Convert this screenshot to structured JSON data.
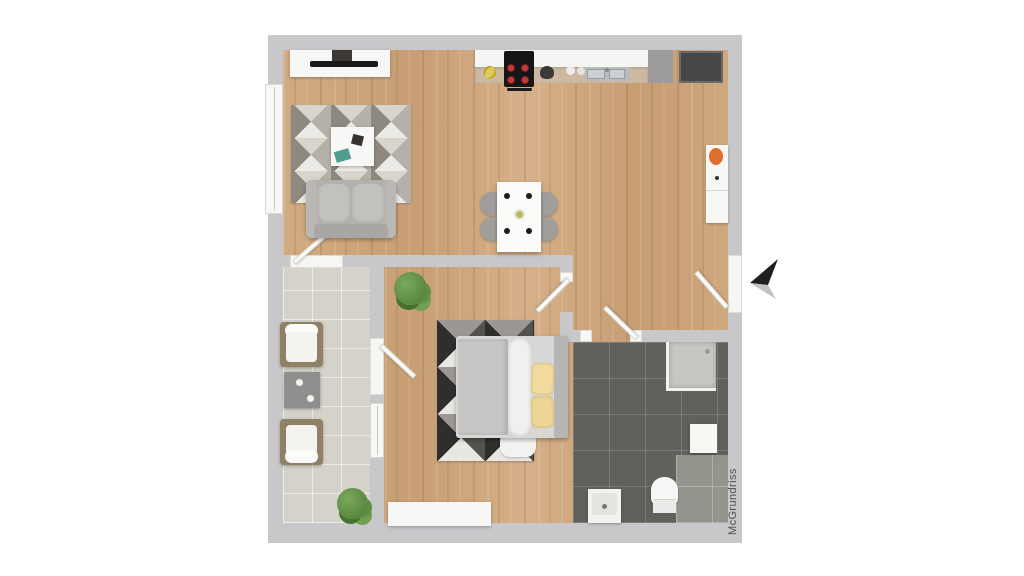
{
  "document": {
    "type": "apartment floor plan, top-down 3D rendering",
    "visible_text": [
      "McGrundriss"
    ]
  },
  "watermark": {
    "text": "McGrundriss",
    "color": "#4e4e4e"
  },
  "annotations": {
    "entrance_arrow": "arrow-icon outside right wall pointing left at the entrance door"
  },
  "palette": {
    "canvas": "#ffffff",
    "wall": "#c8c7ca",
    "wood_floor": "#cda67c",
    "balcony_tile": "#d5d3c9",
    "bathroom_tile": "#5e615c",
    "furniture_white": "#f7f7f5",
    "sofa_gray": "#b3b1ae",
    "pillow_yellow": "#f1dc9d",
    "accent_orange": "#dd6f2d",
    "plant_green": "#5d8f45",
    "arrow_dark": "#1f1f1f",
    "arrow_light": "#c2c2c2"
  },
  "rooms": {
    "living_kitchen_dining": {
      "floor": "wood",
      "items": [
        "tv-sideboard",
        "tv",
        "media-box",
        "geometric-rug",
        "coffee-table",
        "sofa",
        "tall-window",
        "balcony-door",
        "kitchen-counter",
        "cooktop",
        "kitchen-sink",
        "tall-gray-cabinet",
        "dark-cabinet",
        "dining-table",
        "four-dining-chairs",
        "hall-sideboard-with-orange-bowl",
        "entrance-door"
      ]
    },
    "bedroom": {
      "floor": "wood",
      "items": [
        "double-bed-with-yellow-pillows",
        "geometric-rug-dark",
        "plant",
        "wardrobe",
        "balcony-door",
        "window",
        "room-door"
      ]
    },
    "balcony": {
      "floor": "tile",
      "items": [
        "patio-chair",
        "patio-chair",
        "side-table-with-two-cups",
        "plant"
      ]
    },
    "bathroom": {
      "floor": "dark-tile",
      "items": [
        "shower",
        "toilet",
        "washbasin",
        "wall-cabinet",
        "door"
      ]
    }
  }
}
